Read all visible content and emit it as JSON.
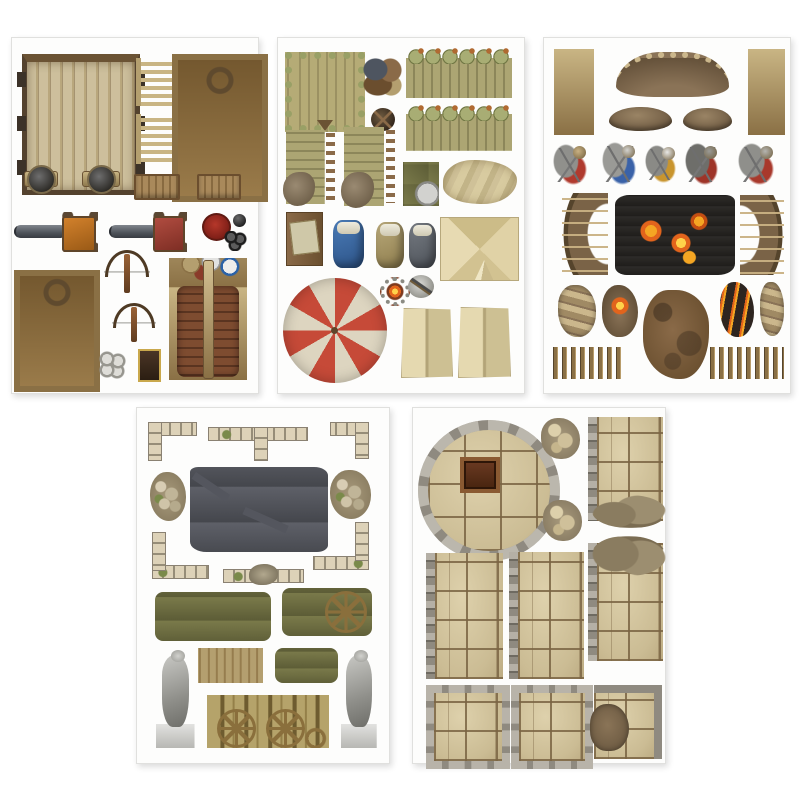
{
  "page": {
    "kind": "product-photo",
    "description": "Five printed punch-out token sheets of medieval fantasy battle-map scenery on a white background: siege weapons, army camp gear, battlefield defenses, ruins, and dungeon stone floors.",
    "background": "#ffffff",
    "sheet_border": "#e0e0de"
  },
  "colors": {
    "wood_light": "#cdbf9c",
    "wood_mid": "#b49f6f",
    "wood_dark": "#5a4733",
    "olive_log": "#aca573",
    "dirt": "#8a7357",
    "rust": "#8a6a48",
    "stone_grey": "#8f8a80",
    "flagstone_tan": "#d6c7a2",
    "grout_brown": "#7a6443",
    "fire_orange": "#e2641c",
    "fire_yellow": "#ffd24a",
    "umbrella_red": "#c64a38",
    "umbrella_cream": "#ddd5c0",
    "carriage_orange": "#d2812c",
    "carriage_red": "#b04c40",
    "statue_grey": "#9a9a96",
    "wall_bluegrey": "#5e6068"
  },
  "sheets": [
    {
      "name": "sheet-siege-weapons",
      "x": 11,
      "y": 37,
      "w": 246,
      "h": 355,
      "items": [
        {
          "name": "wooden-gate-token",
          "type": "gate",
          "x": 10,
          "y": 16,
          "w": 108,
          "h": 128
        },
        {
          "name": "wooden-ladder-token-1",
          "type": "ladder",
          "x": 124,
          "y": 20,
          "w": 32,
          "h": 48
        },
        {
          "name": "wooden-ladder-token-2",
          "type": "ladder",
          "x": 124,
          "y": 76,
          "w": 32,
          "h": 50
        },
        {
          "name": "siege-engine-frame-large",
          "type": "siege-frame",
          "x": 160,
          "y": 16,
          "w": 84,
          "h": 136
        },
        {
          "name": "shield-mount-token-1",
          "type": "shield-token",
          "x": 12,
          "y": 126,
          "w": 34,
          "h": 30
        },
        {
          "name": "shield-mount-token-2",
          "type": "shield-token",
          "x": 70,
          "y": 126,
          "w": 38,
          "h": 30
        },
        {
          "name": "wooden-table-token-1",
          "type": "camp-table",
          "x": 122,
          "y": 136,
          "w": 42,
          "h": 22
        },
        {
          "name": "wooden-table-token-2",
          "type": "camp-table",
          "x": 185,
          "y": 136,
          "w": 40,
          "h": 22
        },
        {
          "name": "cannon-orange-carriage",
          "type": "cannon",
          "cls": "v-orange",
          "x": 2,
          "y": 174,
          "w": 84,
          "h": 40
        },
        {
          "name": "cannon-red-carriage",
          "type": "cannon",
          "cls": "v-red",
          "x": 97,
          "y": 174,
          "w": 78,
          "h": 40
        },
        {
          "name": "red-round-token",
          "type": "token-red",
          "x": 190,
          "y": 175,
          "w": 25,
          "h": 24
        },
        {
          "name": "cannonball-single",
          "type": "ball",
          "x": 221,
          "y": 176,
          "w": 13,
          "h": 13
        },
        {
          "name": "cannonball-cluster-black",
          "type": "balls-black",
          "x": 212,
          "y": 193,
          "w": 23,
          "h": 20
        },
        {
          "name": "siege-engine-frame-small",
          "type": "siege-frame",
          "x": 2,
          "y": 232,
          "w": 74,
          "h": 110
        },
        {
          "name": "crossbow-token-1",
          "type": "crossbow",
          "x": 92,
          "y": 210,
          "w": 46,
          "h": 46
        },
        {
          "name": "crossbow-token-2",
          "type": "crossbow",
          "x": 100,
          "y": 263,
          "w": 44,
          "h": 42
        },
        {
          "name": "battering-ram-token",
          "type": "ram",
          "x": 157,
          "y": 220,
          "w": 78,
          "h": 122
        },
        {
          "name": "cannonball-cluster-grey",
          "type": "balls-grey",
          "x": 86,
          "y": 313,
          "w": 28,
          "h": 28
        },
        {
          "name": "small-banner-token",
          "type": "banner",
          "x": 126,
          "y": 311,
          "w": 19,
          "h": 29
        }
      ]
    },
    {
      "name": "sheet-army-camp",
      "x": 277,
      "y": 37,
      "w": 246,
      "h": 355,
      "items": [
        {
          "name": "log-platform-token",
          "type": "platform",
          "x": 7,
          "y": 14,
          "w": 66,
          "h": 66
        },
        {
          "name": "sack-pile-token",
          "type": "sack-pile",
          "x": 85,
          "y": 20,
          "w": 39,
          "h": 38
        },
        {
          "name": "palisade-wall-token-1",
          "type": "palisade",
          "x": 128,
          "y": 10,
          "w": 106,
          "h": 50
        },
        {
          "name": "palisade-wall-token-2",
          "type": "palisade",
          "x": 128,
          "y": 67,
          "w": 106,
          "h": 46
        },
        {
          "name": "round-shield-token",
          "type": "shield-dark",
          "x": 93,
          "y": 70,
          "w": 24,
          "h": 23
        },
        {
          "name": "broken-palisade-token-1",
          "type": "palisade-broken",
          "x": 8,
          "y": 92,
          "w": 51,
          "h": 74
        },
        {
          "name": "broken-palisade-token-2",
          "type": "palisade-broken",
          "x": 66,
          "y": 89,
          "w": 53,
          "h": 79
        },
        {
          "name": "supply-pile-token",
          "type": "supply-pile",
          "x": 125,
          "y": 124,
          "w": 36,
          "h": 44
        },
        {
          "name": "crumpled-tarp-token",
          "type": "tarp",
          "x": 165,
          "y": 122,
          "w": 74,
          "h": 44
        },
        {
          "name": "map-board-token",
          "type": "map-board",
          "x": 8,
          "y": 174,
          "w": 35,
          "h": 52
        },
        {
          "name": "bedroll-blue-token",
          "type": "bedroll",
          "cls": "v-blue",
          "x": 55,
          "y": 182,
          "w": 31,
          "h": 48
        },
        {
          "name": "bedroll-tan-token",
          "type": "bedroll",
          "cls": "v-tan",
          "x": 98,
          "y": 184,
          "w": 28,
          "h": 46
        },
        {
          "name": "bedroll-grey-token",
          "type": "bedroll",
          "cls": "v-grey",
          "x": 131,
          "y": 185,
          "w": 27,
          "h": 45
        },
        {
          "name": "square-tent-top-token",
          "type": "tent",
          "x": 162,
          "y": 179,
          "w": 77,
          "h": 62
        },
        {
          "name": "campfire-token",
          "type": "campfire",
          "x": 102,
          "y": 239,
          "w": 22,
          "h": 21
        },
        {
          "name": "plate-with-axe-token",
          "type": "plate-axe",
          "x": 130,
          "y": 237,
          "w": 26,
          "h": 23
        },
        {
          "name": "striped-parasol-token",
          "type": "umbrella",
          "x": 5,
          "y": 240,
          "w": 104,
          "h": 105
        },
        {
          "name": "tent-panel-token-1",
          "type": "tent-panel",
          "x": 123,
          "y": 270,
          "w": 50,
          "h": 68
        },
        {
          "name": "tent-panel-token-2",
          "type": "tent-panel",
          "x": 180,
          "y": 269,
          "w": 51,
          "h": 69
        }
      ]
    },
    {
      "name": "sheet-battlefield-defenses",
      "x": 543,
      "y": 37,
      "w": 246,
      "h": 355,
      "items": [
        {
          "name": "spike-barricade-left",
          "type": "spike-col",
          "x": 10,
          "y": 11,
          "w": 40,
          "h": 86
        },
        {
          "name": "sandbag-trench-curved",
          "type": "trench",
          "x": 72,
          "y": 14,
          "w": 113,
          "h": 39
        },
        {
          "name": "spike-barricade-right",
          "type": "spike-col",
          "x": 204,
          "y": 11,
          "w": 37,
          "h": 86
        },
        {
          "name": "dirt-mound-token-1",
          "type": "mound",
          "x": 65,
          "y": 69,
          "w": 63,
          "h": 24
        },
        {
          "name": "dirt-mound-token-2",
          "type": "mound",
          "x": 139,
          "y": 70,
          "w": 49,
          "h": 23
        },
        {
          "name": "fallen-soldier-token-1",
          "type": "casualty",
          "cls": "cv1",
          "x": 9,
          "y": 106,
          "w": 34,
          "h": 41
        },
        {
          "name": "fallen-soldier-token-2",
          "type": "casualty",
          "cls": "cv2",
          "x": 58,
          "y": 104,
          "w": 34,
          "h": 43
        },
        {
          "name": "fallen-soldier-token-3",
          "type": "casualty",
          "cls": "cv3",
          "x": 101,
          "y": 107,
          "w": 31,
          "h": 38
        },
        {
          "name": "fallen-soldier-token-4",
          "type": "casualty",
          "cls": "cv4",
          "x": 141,
          "y": 105,
          "w": 33,
          "h": 42
        },
        {
          "name": "fallen-soldier-token-5",
          "type": "casualty",
          "cls": "cv5",
          "x": 194,
          "y": 105,
          "w": 36,
          "h": 42
        },
        {
          "name": "cheval-de-frise-left",
          "type": "cheval",
          "x": 18,
          "y": 155,
          "w": 46,
          "h": 82
        },
        {
          "name": "burning-wreckage-token",
          "type": "burn-wreck",
          "x": 71,
          "y": 157,
          "w": 120,
          "h": 80
        },
        {
          "name": "cheval-de-frise-right",
          "type": "cheval",
          "cls": "flip",
          "x": 196,
          "y": 157,
          "w": 44,
          "h": 80
        },
        {
          "name": "sandbag-curve-token",
          "type": "sandbag-piece",
          "x": 14,
          "y": 247,
          "w": 38,
          "h": 52
        },
        {
          "name": "campfire-ground-token",
          "type": "fire-patch",
          "x": 58,
          "y": 247,
          "w": 36,
          "h": 52
        },
        {
          "name": "scorched-ground-patch",
          "type": "rust-patch",
          "x": 99,
          "y": 252,
          "w": 66,
          "h": 89
        },
        {
          "name": "burning-debris-token",
          "type": "burning-debris",
          "x": 176,
          "y": 244,
          "w": 34,
          "h": 55
        },
        {
          "name": "sandbag-strip-token",
          "type": "sandbag-piece",
          "x": 216,
          "y": 244,
          "w": 24,
          "h": 54
        },
        {
          "name": "stake-row-left",
          "type": "stake-row",
          "x": 9,
          "y": 309,
          "w": 72,
          "h": 32
        },
        {
          "name": "stake-row-right",
          "type": "stake-row",
          "x": 166,
          "y": 309,
          "w": 74,
          "h": 32
        }
      ]
    },
    {
      "name": "sheet-ruins",
      "x": 136,
      "y": 407,
      "w": 252,
      "h": 355,
      "items": [
        {
          "name": "ruined-corner-wall-left",
          "type": "corner",
          "x": 11,
          "y": 14,
          "w": 49,
          "h": 39
        },
        {
          "name": "ruined-t-wall",
          "type": "twall",
          "x": 71,
          "y": 12,
          "w": 100,
          "h": 41
        },
        {
          "name": "ruined-corner-wall-right",
          "type": "corner",
          "cls": "flip",
          "x": 193,
          "y": 14,
          "w": 39,
          "h": 37
        },
        {
          "name": "rubble-pile-left",
          "type": "rubble-pile",
          "x": 13,
          "y": 64,
          "w": 36,
          "h": 49
        },
        {
          "name": "ruined-building-floor",
          "type": "ruin-building",
          "x": 53,
          "y": 59,
          "w": 138,
          "h": 85
        },
        {
          "name": "rubble-pile-right",
          "type": "rubble-pile",
          "x": 193,
          "y": 62,
          "w": 41,
          "h": 49
        },
        {
          "name": "ruined-l-wall-left",
          "type": "lwall",
          "x": 15,
          "y": 124,
          "w": 57,
          "h": 51
        },
        {
          "name": "wall-with-rubble-token",
          "type": "wallrubble",
          "x": 86,
          "y": 155,
          "w": 81,
          "h": 23
        },
        {
          "name": "ruined-l-wall-right",
          "type": "lwall",
          "cls": "flip",
          "x": 176,
          "y": 114,
          "w": 56,
          "h": 52
        },
        {
          "name": "debris-pile-crates",
          "type": "debris-pile",
          "x": 18,
          "y": 184,
          "w": 116,
          "h": 49
        },
        {
          "name": "debris-pile-with-wheel",
          "type": "debris-pile",
          "cls": "v-wheel",
          "x": 145,
          "y": 180,
          "w": 90,
          "h": 48
        },
        {
          "name": "statue-monk-token",
          "type": "statue",
          "x": 18,
          "y": 240,
          "w": 41,
          "h": 100
        },
        {
          "name": "debris-lean-to-token",
          "type": "roof-debris",
          "x": 61,
          "y": 240,
          "w": 65,
          "h": 35
        },
        {
          "name": "debris-crates-small",
          "type": "debris-pile",
          "x": 138,
          "y": 240,
          "w": 63,
          "h": 35
        },
        {
          "name": "statue-robed-token",
          "type": "statue",
          "x": 203,
          "y": 240,
          "w": 38,
          "h": 100
        },
        {
          "name": "wooden-cart-token",
          "type": "cart",
          "x": 70,
          "y": 287,
          "w": 122,
          "h": 53
        }
      ]
    },
    {
      "name": "sheet-dungeon-floors",
      "x": 412,
      "y": 407,
      "w": 252,
      "h": 355,
      "items": [
        {
          "name": "round-tower-floor",
          "type": "round-floor",
          "x": 5,
          "y": 12,
          "w": 122,
          "h": 121
        },
        {
          "name": "rubble-patch-1",
          "type": "rubble-patch",
          "x": 128,
          "y": 10,
          "w": 39,
          "h": 41
        },
        {
          "name": "stone-floor-broken-bottom",
          "type": "floor-strip",
          "cls": "floor edge-l broken-b",
          "x": 175,
          "y": 9,
          "w": 66,
          "h": 104
        },
        {
          "name": "rubble-patch-2",
          "type": "rubble-patch",
          "x": 130,
          "y": 92,
          "w": 39,
          "h": 41
        },
        {
          "name": "stone-floor-strip-left",
          "type": "floor-strip",
          "cls": "floor edge-l",
          "x": 13,
          "y": 145,
          "w": 68,
          "h": 126
        },
        {
          "name": "stone-floor-strip-center",
          "type": "floor-strip",
          "cls": "floor edge-l",
          "x": 96,
          "y": 144,
          "w": 66,
          "h": 127
        },
        {
          "name": "stone-floor-broken-top",
          "type": "floor-strip",
          "cls": "floor edge-l broken-t",
          "x": 175,
          "y": 135,
          "w": 66,
          "h": 118
        },
        {
          "name": "stone-room-square-1",
          "type": "square-room",
          "cls": "floor",
          "x": 13,
          "y": 277,
          "w": 68,
          "h": 68
        },
        {
          "name": "stone-room-square-2",
          "type": "square-room",
          "cls": "floor",
          "x": 98,
          "y": 277,
          "w": 66,
          "h": 68
        },
        {
          "name": "stone-floor-broken-corner",
          "type": "square-broken",
          "cls": "floor",
          "x": 181,
          "y": 277,
          "w": 60,
          "h": 66
        }
      ]
    }
  ]
}
